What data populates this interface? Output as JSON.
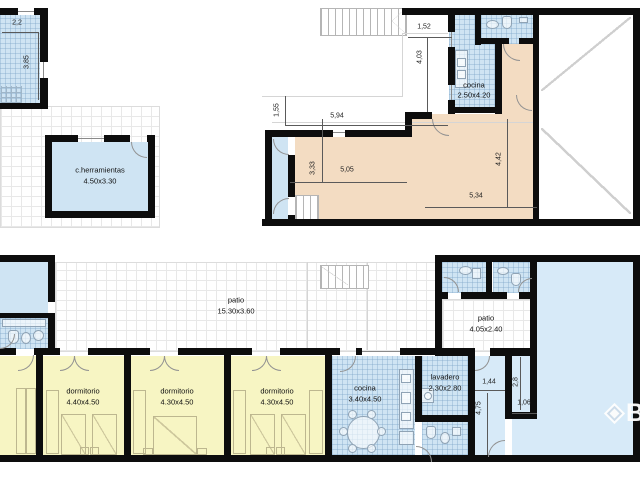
{
  "upper_floor": {
    "rooms": [
      {
        "name": "c.herramientas",
        "size": "4.50x3.30"
      },
      {
        "name": "cocina",
        "size": "2.50x4.20"
      }
    ],
    "dims": [
      "2,2",
      "3,85",
      "1,52",
      "4,03",
      "5,94",
      "1,55",
      "3,33",
      "5,05",
      "4,42",
      "5,34"
    ]
  },
  "lower_floor": {
    "rooms": [
      {
        "name": "patio",
        "size": "15.30x3.60"
      },
      {
        "name": "patio",
        "size": "4.05x2.40"
      },
      {
        "name": "dormitorio",
        "size": "4.40x4.50"
      },
      {
        "name": "dormitorio",
        "size": "4.30x4.50"
      },
      {
        "name": "dormitorio",
        "size": "4.30x4.50"
      },
      {
        "name": "cocina",
        "size": "3.40x4.50"
      },
      {
        "name": "lavadero",
        "size": "2.30x2.80"
      }
    ],
    "dims": [
      "1,44",
      "4,75",
      "2,8",
      "1,06"
    ]
  },
  "watermark": {
    "letter": "B"
  },
  "colors": {
    "wall": "#0d0d0d",
    "room_blue": "#cfe4f3",
    "pool_blue": "#d7eaf8",
    "bedroom_yellow": "#f7f5c3",
    "living_beige": "#f3dcc2"
  }
}
